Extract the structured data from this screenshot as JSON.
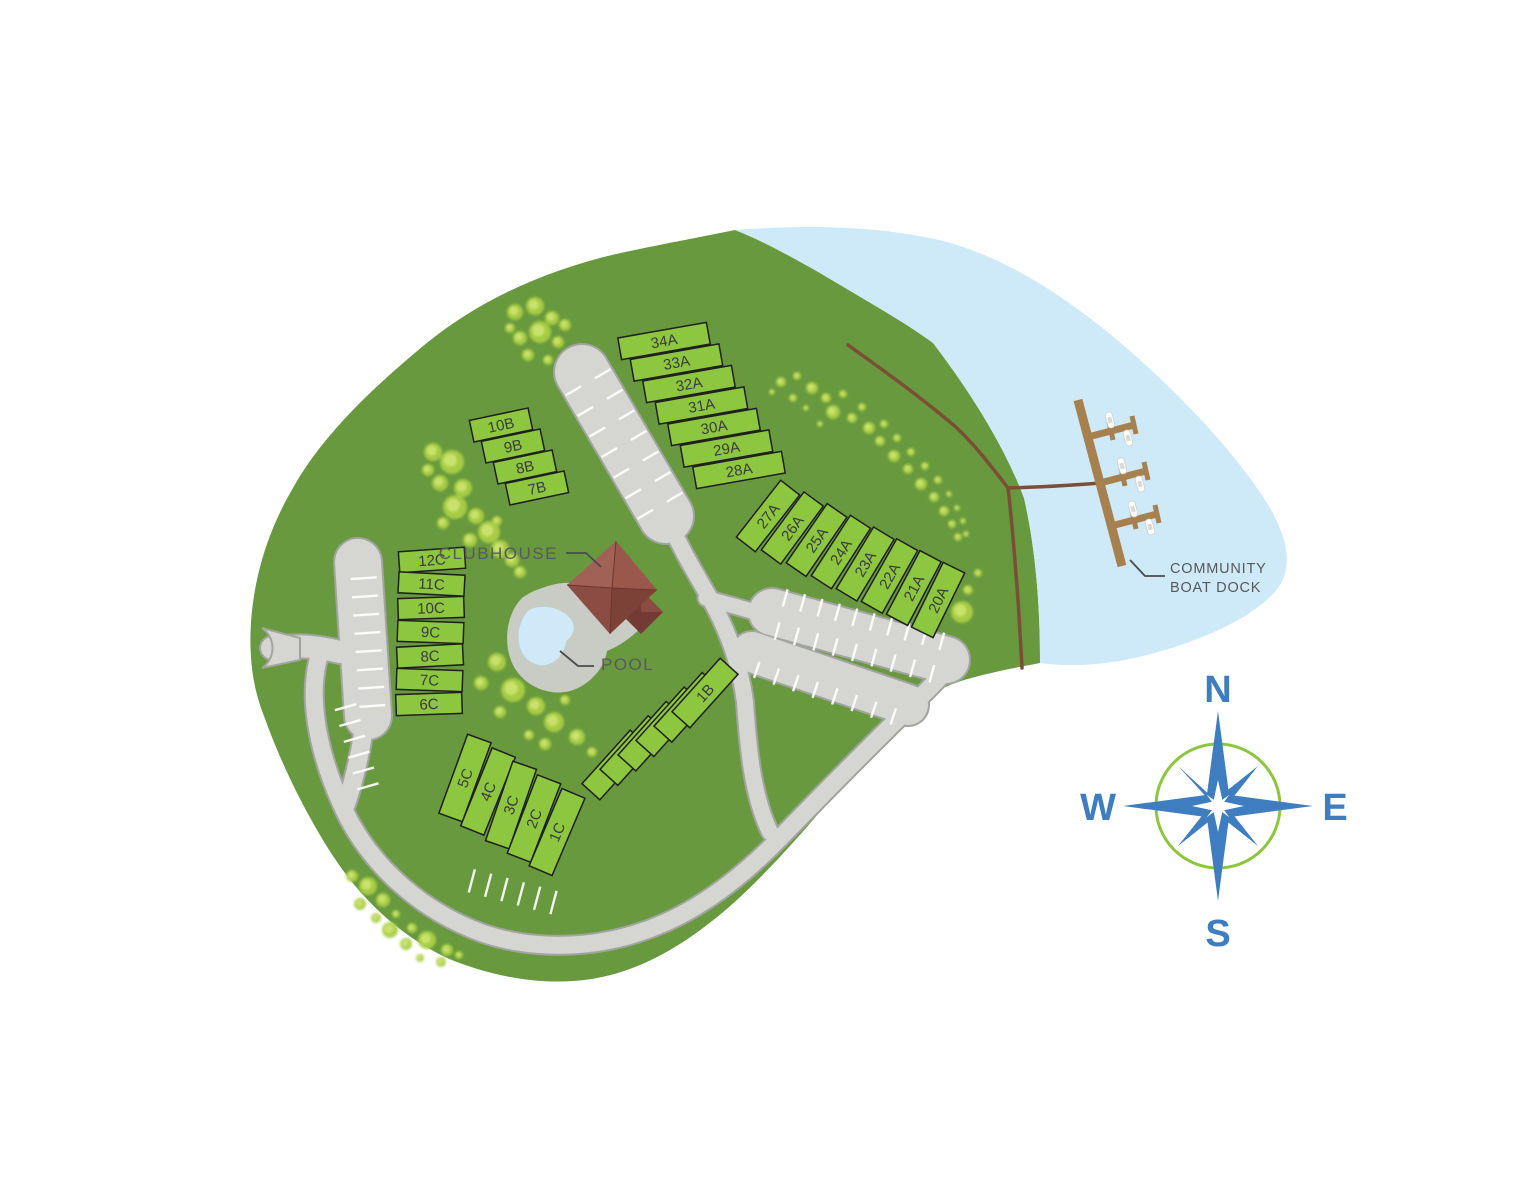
{
  "map": {
    "labels": {
      "clubhouse": "CLUBHOUSE",
      "pool": "POOL",
      "boat_dock_line1": "COMMUNITY",
      "boat_dock_line2": "BOAT DOCK"
    },
    "lot_groups": [
      {
        "name": "b-top",
        "lots": [
          "10B",
          "9B",
          "8B",
          "7B"
        ]
      },
      {
        "name": "a-top",
        "lots": [
          "34A",
          "33A",
          "32A",
          "31A",
          "30A",
          "29A",
          "28A"
        ]
      },
      {
        "name": "a-east",
        "lots": [
          "27A",
          "26A",
          "25A",
          "24A",
          "23A",
          "22A",
          "21A",
          "20A"
        ]
      },
      {
        "name": "c-west",
        "lots": [
          "12C",
          "11C",
          "10C",
          "9C",
          "8C",
          "7C",
          "6C"
        ]
      },
      {
        "name": "c-south",
        "lots": [
          "5C",
          "4C",
          "3C",
          "2C",
          "1C"
        ]
      },
      {
        "name": "b-south",
        "lots": [
          "6B",
          "5B",
          "4B",
          "3B",
          "2B",
          "1B"
        ]
      }
    ],
    "compass": {
      "n": "N",
      "e": "E",
      "s": "S",
      "w": "W"
    },
    "colors": {
      "land": "#68993e",
      "water": "#cee9f8",
      "lot_fill": "#8dc63f",
      "lot_border": "#1f1f1f",
      "road_fill": "#d5d6d1",
      "road_edge": "#a2a49f",
      "stripe": "#ffffff",
      "trail": "#7a4e37",
      "dock": "#a6814f",
      "clubhouse_main": "#9a574c",
      "clubhouse_dark": "#7c4238",
      "pool_water": "#cfe9f8",
      "pool_deck": "#c9cbc5",
      "tree": "#a9cf45",
      "tree_light": "#cde470",
      "compass_blue": "#3e7dbf",
      "compass_ring": "#8cc63e",
      "label_text": "#58595b"
    }
  }
}
